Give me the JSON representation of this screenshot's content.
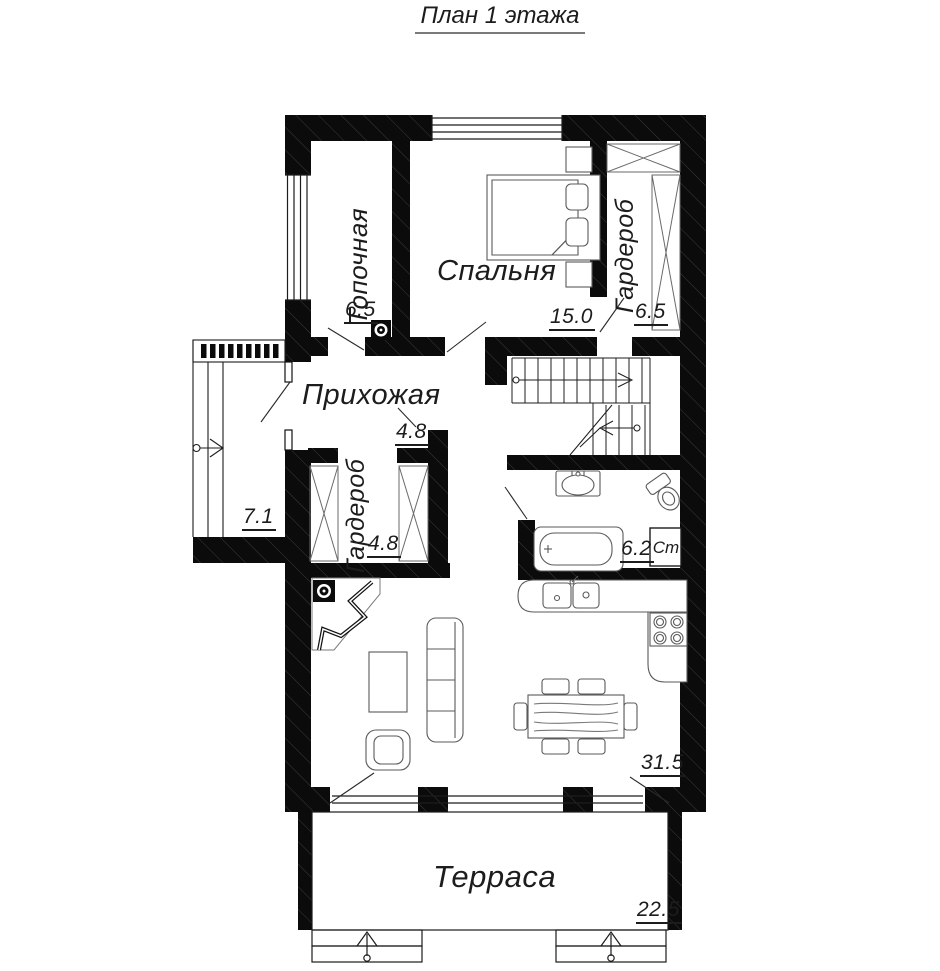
{
  "title": "План 1 этажа",
  "rooms": {
    "boiler": {
      "name": "Топочная",
      "area": "6.5"
    },
    "bedroom": {
      "name": "Спальня",
      "area": "15.0"
    },
    "wardrobe_top": {
      "name": "Гардероб",
      "area": "6.5"
    },
    "hallway": {
      "name": "Прихожая",
      "area": "4.8"
    },
    "wardrobe_low": {
      "name": "Гардероб",
      "area": "4.8"
    },
    "porch": {
      "area": "7.1"
    },
    "bathroom": {
      "area": "6.2"
    },
    "living_kitchen": {
      "area": "31.5"
    },
    "terrace": {
      "name": "Терраса",
      "area": "22.5"
    }
  },
  "appliances": {
    "washing_machine": "Ст"
  },
  "colors": {
    "wall": "#0b0b0b",
    "ink": "#1c1c1c"
  }
}
